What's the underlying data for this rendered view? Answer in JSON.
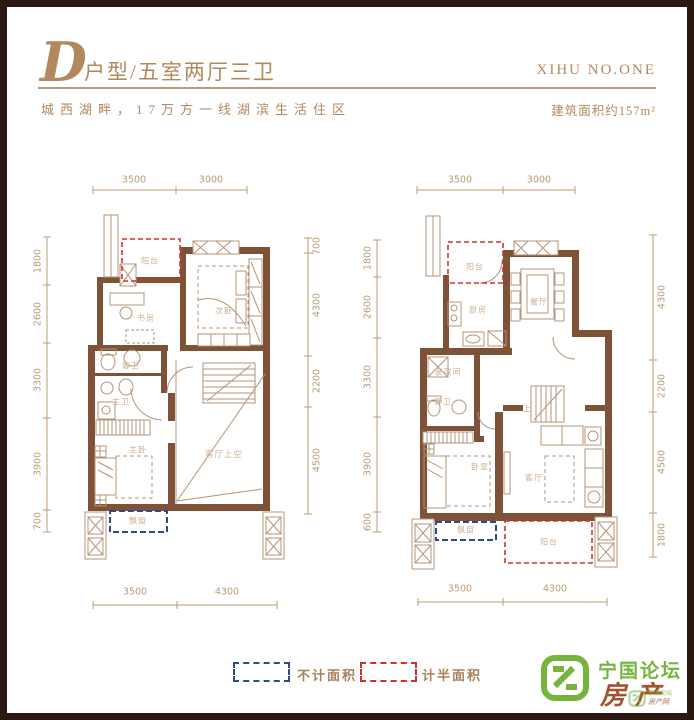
{
  "header": {
    "letter": "D",
    "type": "户型/五室两厅三卫",
    "brand": "XIHU NO.ONE",
    "slogan": "城西湖畔，17万方一线湖滨生活住区",
    "area": "建筑面积约157m²"
  },
  "plan_left": {
    "top_dims": [
      "3500",
      "3000"
    ],
    "bottom_dims": [
      "3500",
      "4300"
    ],
    "left_dims": [
      "1800",
      "2600",
      "3300",
      "3900",
      "700"
    ],
    "right_dims": [
      "700",
      "4300",
      "2200",
      "4500"
    ],
    "rooms": {
      "balcony": "阳台",
      "study": "书房",
      "bedroom2": "次卧",
      "guest_bath": "客卫",
      "master_bath": "主卫",
      "master_bed": "主卧",
      "void": "客厅上空",
      "bay": "飘窗"
    }
  },
  "plan_right": {
    "top_dims": [
      "3500",
      "3000"
    ],
    "bottom_dims": [
      "3500",
      "4300"
    ],
    "left_dims": [
      "1800",
      "2600",
      "3300",
      "3900",
      "600"
    ],
    "right_dims": [
      "4300",
      "2200",
      "4500",
      "1800"
    ],
    "rooms": {
      "balcony": "阳台",
      "kitchen": "厨房",
      "dining": "餐厅",
      "laundry": "家政间",
      "guest_bath": "客卫",
      "bedroom": "卧室",
      "living": "客厅",
      "stairs": "上",
      "bay": "飘窗",
      "balcony2": "阳台"
    }
  },
  "legend": {
    "not_counted": "不计面积",
    "half_counted": "计半面积"
  },
  "logo": {
    "title": "宁国论坛",
    "subtitle": "房产网"
  },
  "colors": {
    "gold": "#b1895d",
    "wall": "#7d5236",
    "dashed_red": "#cd3429",
    "dashed_blue": "#2d4a8d",
    "logo_green": "#76b43e",
    "frame": "#2b1810"
  }
}
